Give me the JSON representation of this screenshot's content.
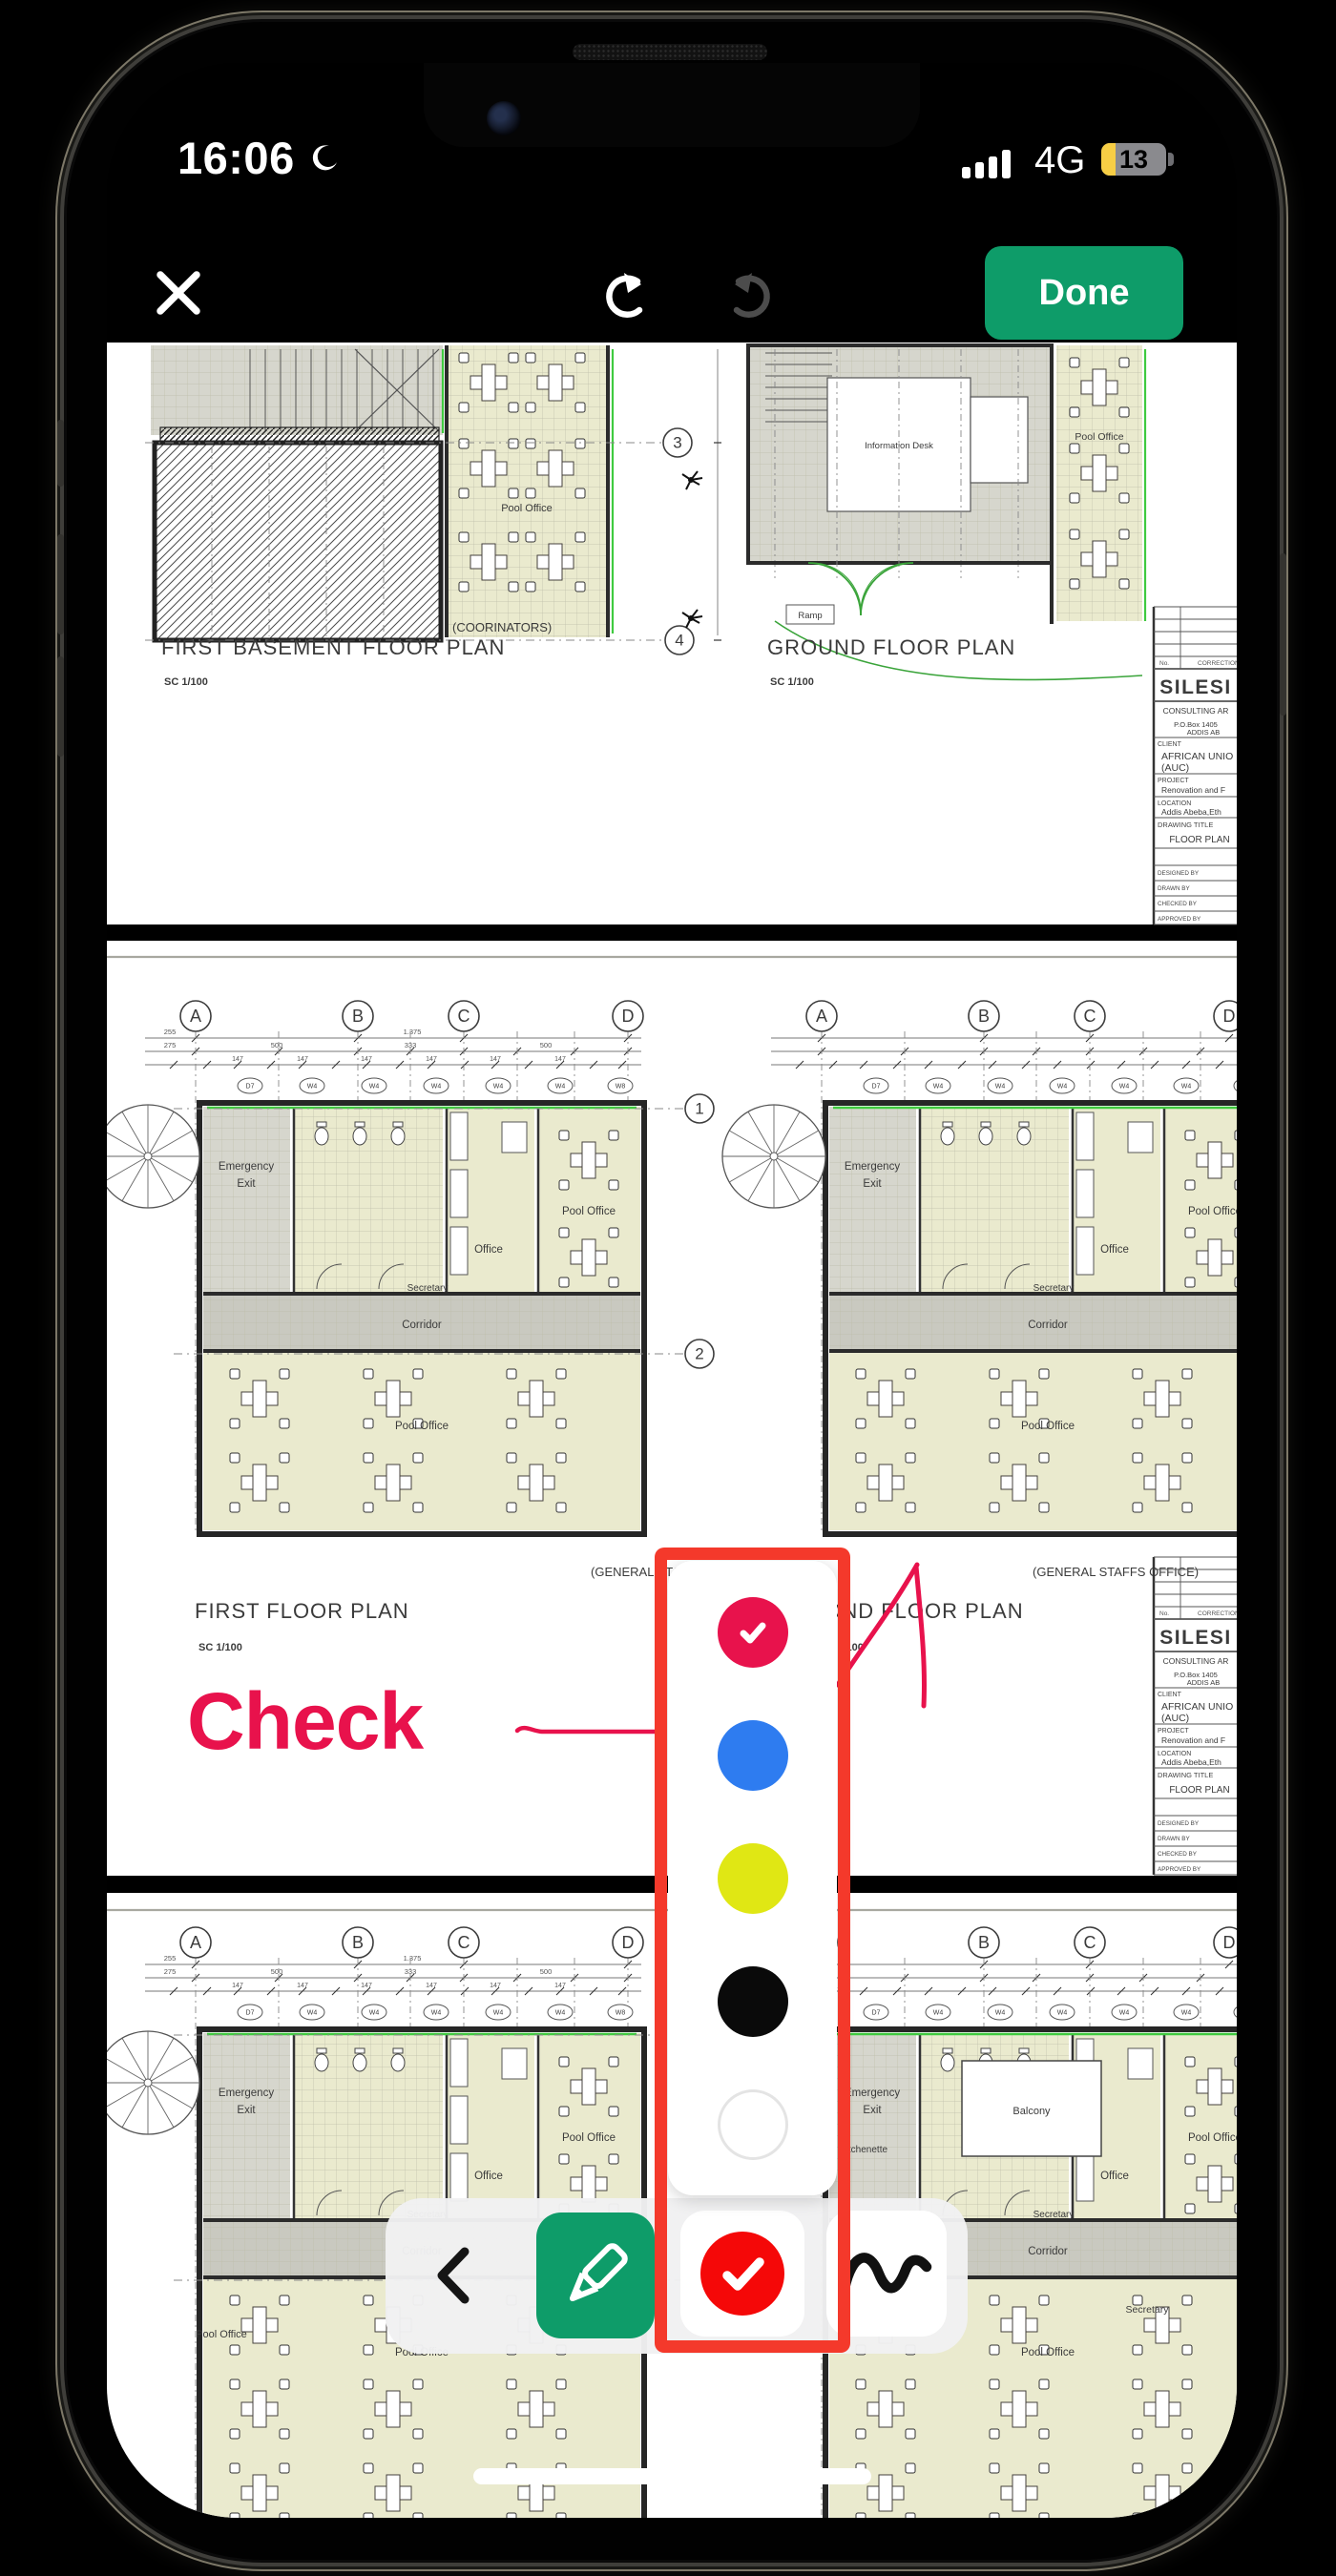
{
  "status_bar": {
    "time": "16:06",
    "network": "4G",
    "battery_percent": "13"
  },
  "top_toolbar": {
    "done": "Done"
  },
  "annotation": {
    "text": "Check",
    "ink_color": "#e8124c"
  },
  "color_picker": {
    "highlight_color": "#f4392b",
    "swatches": [
      {
        "name": "pink",
        "hex": "#e8124c",
        "selected": true
      },
      {
        "name": "blue",
        "hex": "#2e7cf0",
        "selected": false
      },
      {
        "name": "yellow",
        "hex": "#e0e714",
        "selected": false
      },
      {
        "name": "black",
        "hex": "#0a0a0a",
        "selected": false
      },
      {
        "name": "white",
        "hex": "#ffffff",
        "selected": false
      }
    ]
  },
  "bottom_toolbar": {
    "pen_color": "#0e9c69",
    "active_color": "#f50808",
    "tools": [
      "back",
      "pen",
      "color",
      "scribble"
    ]
  },
  "plan_labels": {
    "p1l_title": "FIRST BASEMENT FLOOR PLAN",
    "p1l_scale": "SC 1/100",
    "p1l_note": "(COORINATORS)",
    "p1r_title": "GROUND FLOOR PLAN",
    "p1r_scale": "SC 1/100",
    "p2l_title": "FIRST FLOOR PLAN",
    "p2l_scale": "SC 1/100",
    "p2l_note": "(GENERAL STAFFS OFFICE)",
    "p2r_title": "SECOND FLOOR PLAN",
    "p2r_scale": "SC 1/100",
    "p2r_note": "(GENERAL STAFFS OFFICE)",
    "rooms": {
      "pool_office": "Pool Office",
      "office": "Office",
      "corridor": "Corridor",
      "emergency": "Emergency",
      "exit": "Exit",
      "secretary": "Secretary",
      "kitchenette": "Kitchenette",
      "balcony": "Balcony",
      "info_desk": "Information Desk",
      "ramp": "Ramp"
    },
    "markers": {
      "d7": "D7",
      "w4": "W4",
      "w8": "W8"
    },
    "grid_letters": [
      "A",
      "B",
      "C",
      "D"
    ],
    "grid_numbers": [
      "1",
      "2",
      "3",
      "4"
    ],
    "dims": [
      "255",
      "275",
      "500",
      "333",
      "147",
      "1.375",
      "137"
    ]
  },
  "title_block": {
    "no": "No.",
    "correction": "CORRECTION",
    "firm": "SILESI",
    "firm_type": "CONSULTING AR",
    "addr1": "P.O.Box 1405",
    "addr2": "ADDIS AB",
    "client_label": "CLIENT",
    "client1": "AFRICAN UNIO",
    "client2": "(AUC)",
    "project_label": "PROJECT",
    "project": "Renovation and F",
    "location_label": "LOCATION",
    "location": "Addis Abeba,Eth",
    "drawing_title_label": "DRAWING TITLE",
    "drawing_title": "FLOOR PLAN",
    "designed": "DESIGNED BY",
    "drawn": "DRAWN BY",
    "checked": "CHECKED BY",
    "approved": "APPROVED BY"
  }
}
